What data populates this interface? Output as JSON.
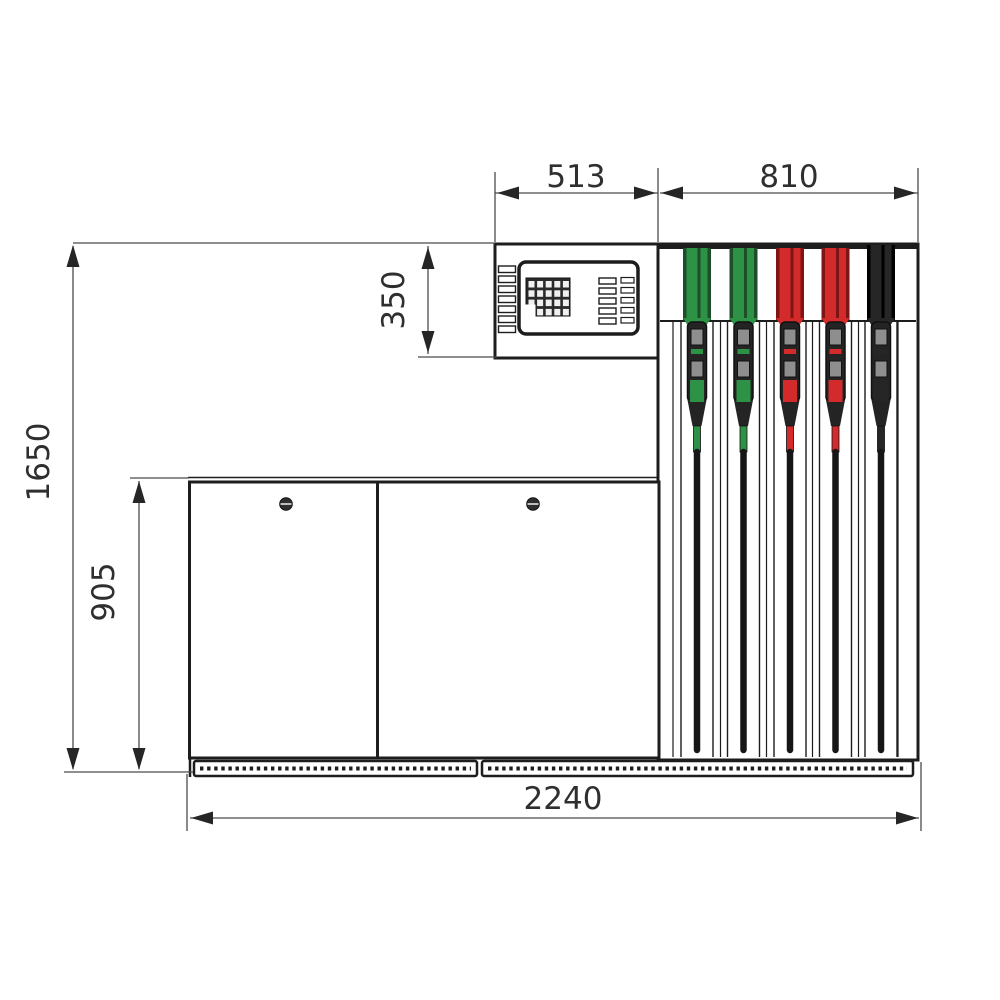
{
  "drawing": {
    "type": "front-view technical drawing of a fuel dispenser with dimension lines",
    "dimensions": {
      "head_width": "513",
      "nozzle_section_width": "810",
      "head_height": "350",
      "total_height": "1650",
      "cabinet_height": "905",
      "total_width": "2240"
    },
    "nozzles": [
      {
        "position": 1,
        "color": "green"
      },
      {
        "position": 2,
        "color": "green"
      },
      {
        "position": 3,
        "color": "red"
      },
      {
        "position": 4,
        "color": "red"
      },
      {
        "position": 5,
        "color": "black"
      }
    ],
    "cabinet": {
      "doors": 2,
      "locks_per_door": 1
    }
  },
  "colors": {
    "line": "#1d1d1d",
    "dim": "#4a4a4a",
    "arrow": "#262626",
    "text": "#2f2f2f",
    "green": "#2e9246",
    "green_dark": "#1c4f27",
    "red": "#d32b2b",
    "red_dark": "#7e1414",
    "black": "#262626",
    "black_dark": "#000000",
    "gray": "#8e8e8e",
    "body": "#242424",
    "hose": "#161616",
    "keypad": "#2a2a2a",
    "key": "#f0f0f0"
  }
}
